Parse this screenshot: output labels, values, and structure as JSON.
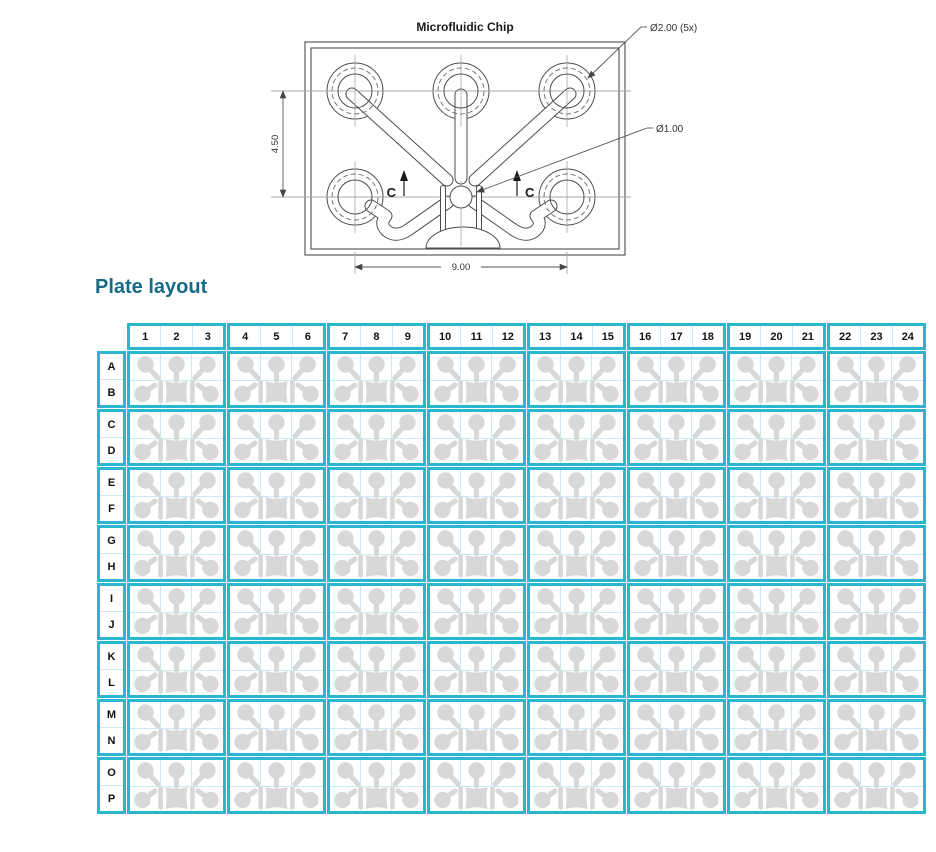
{
  "drawing": {
    "title": "Microfluidic Chip",
    "label_port": "Ø2.00 (5x)",
    "label_center": "Ø1.00",
    "dim_vertical": "4.50",
    "dim_horizontal": "9.00",
    "section_label_left": "C",
    "section_label_right": "C"
  },
  "plate": {
    "heading": "Plate layout",
    "columns": [
      "1",
      "2",
      "3",
      "4",
      "5",
      "6",
      "7",
      "8",
      "9",
      "10",
      "11",
      "12",
      "13",
      "14",
      "15",
      "16",
      "17",
      "18",
      "19",
      "20",
      "21",
      "22",
      "23",
      "24"
    ],
    "rows": [
      "A",
      "B",
      "C",
      "D",
      "E",
      "F",
      "G",
      "H",
      "I",
      "J",
      "K",
      "L",
      "M",
      "N",
      "O",
      "P"
    ],
    "block_columns": 3,
    "block_rows": 2
  },
  "colors": {
    "accent_teal": "#29b6ce",
    "well_gridline": "#c9ecf4",
    "chip_glyph_gray": "#d8d8d8",
    "heading_text": "#176b87",
    "drawing_line": "#4d4d4d"
  }
}
